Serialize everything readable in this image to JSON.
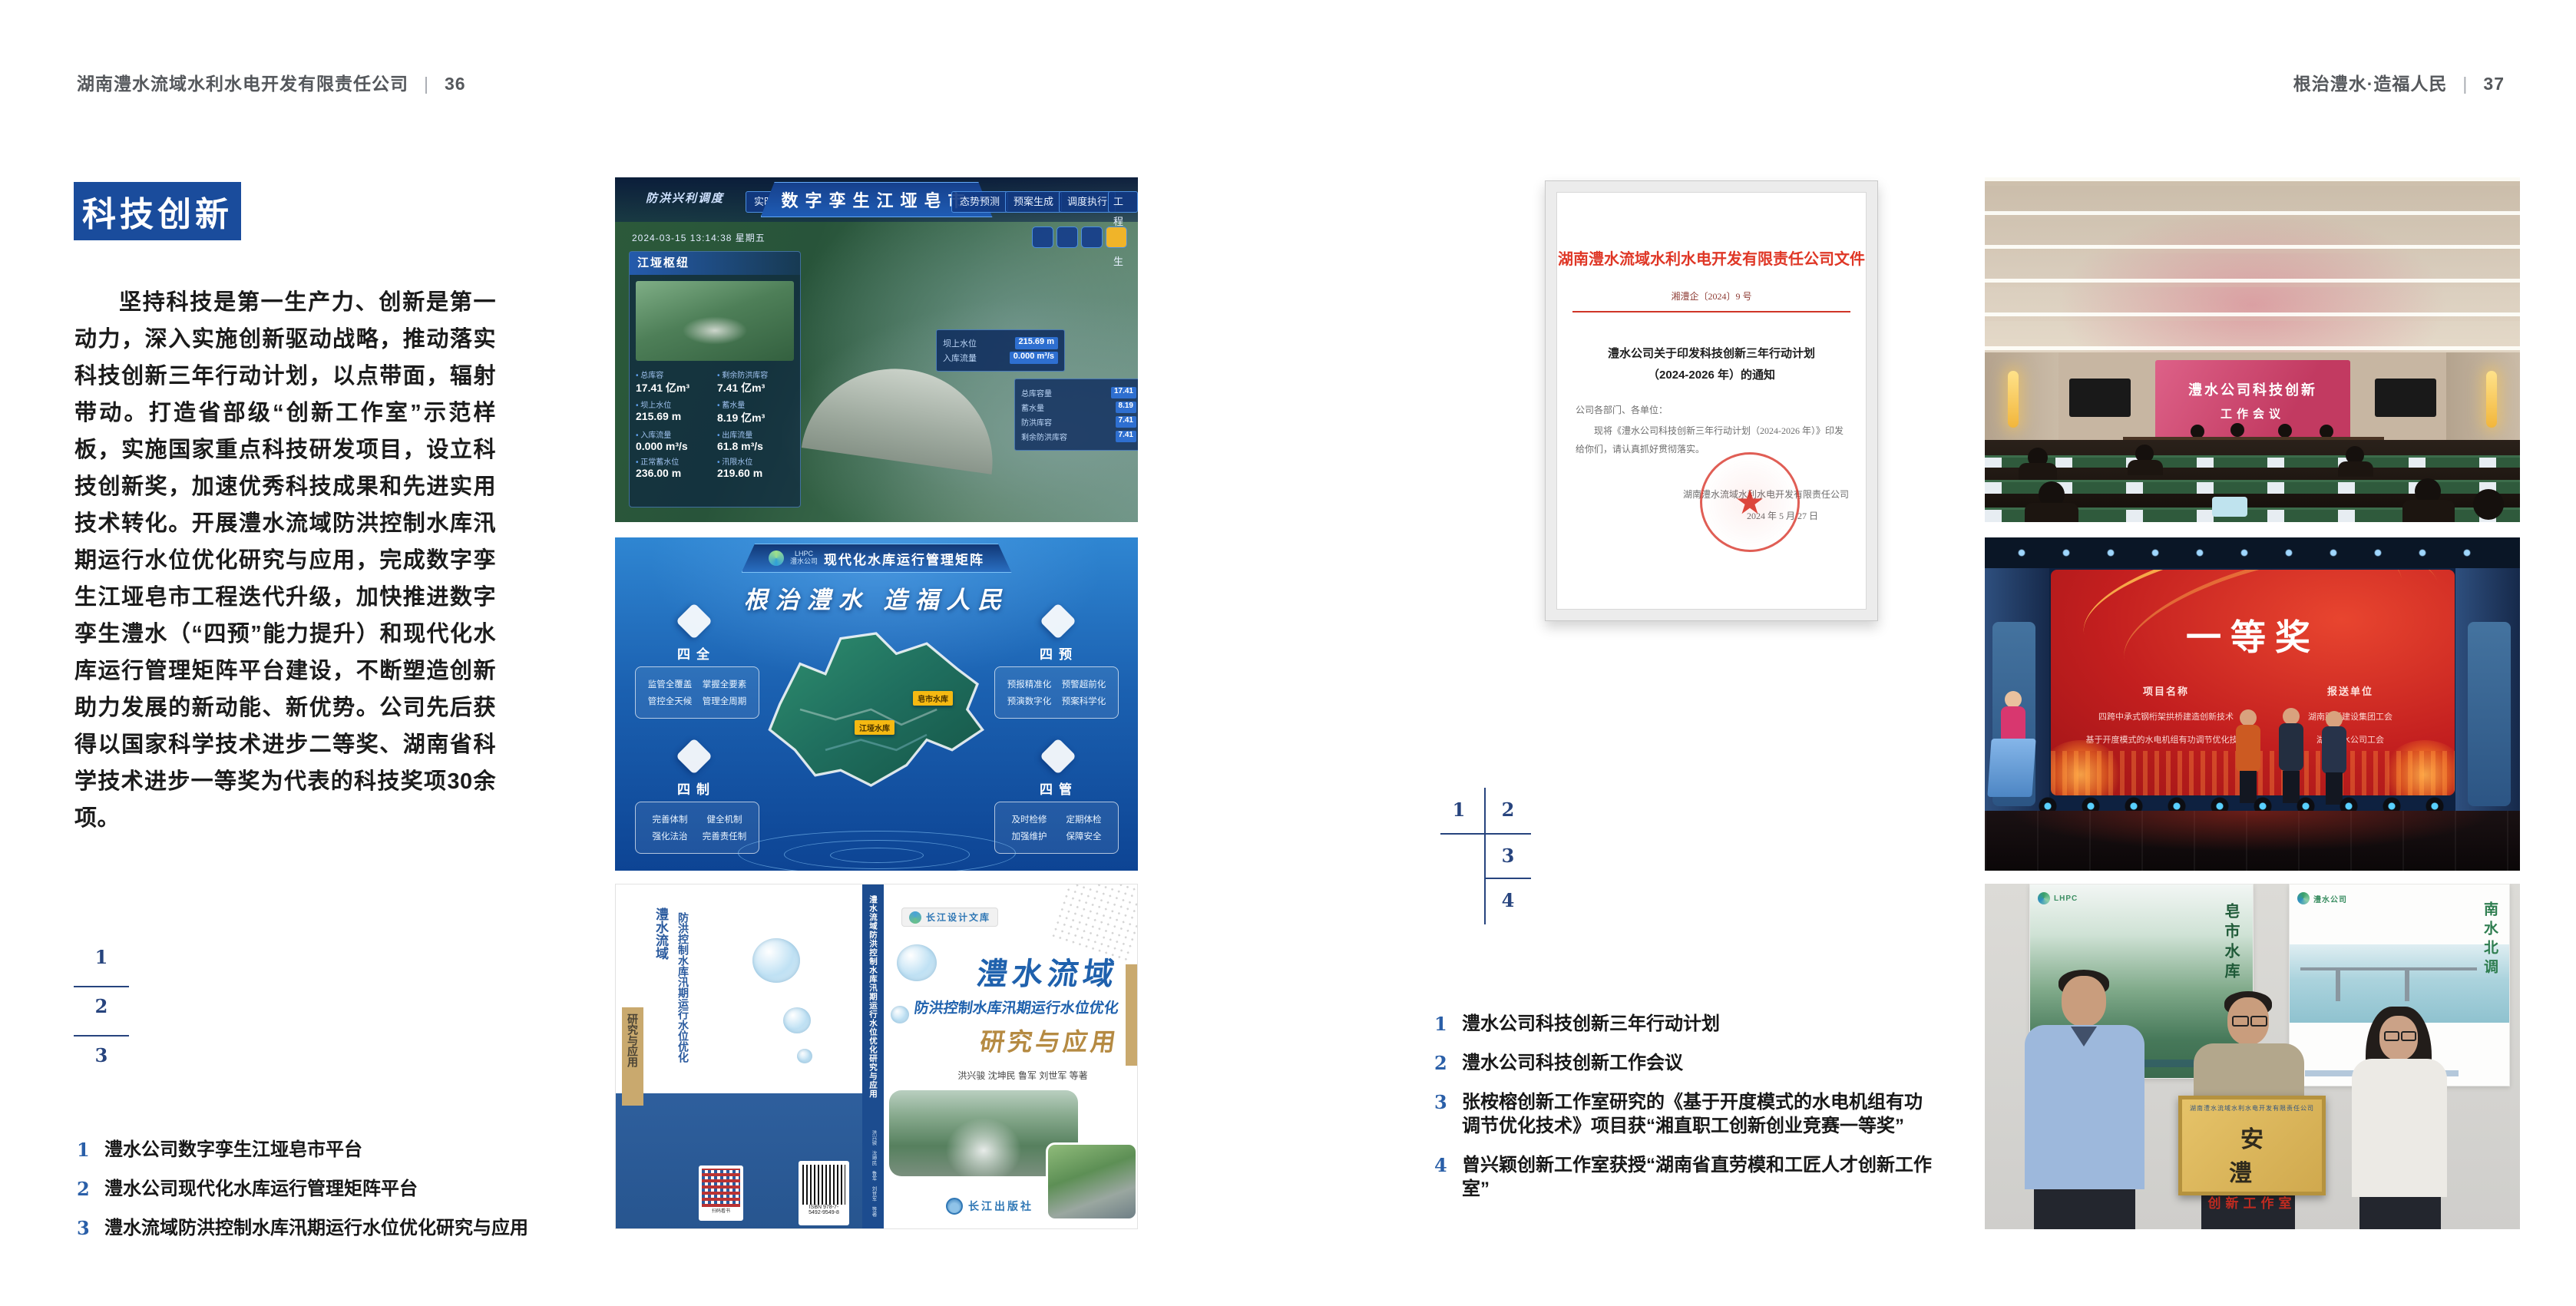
{
  "page_left": {
    "header": {
      "company": "湖南澧水流域水利水电开发有限责任公司",
      "separator": "|",
      "page_number": "36"
    },
    "section_title": "科技创新",
    "paragraph": "坚持科技是第一生产力、创新是第一动力，深入实施创新驱动战略，推动落实科技创新三年行动计划，以点带面，辐射带动。打造省部级“创新工作室”示范样板，实施国家重点科技研发项目，设立科技创新奖，加速优秀科技成果和先进实用技术转化。开展澧水流域防洪控制水库汛期运行水位优化研究与应用，完成数字孪生江垭皂市工程迭代升级，加快推进数字孪生澧水（“四预”能力提升）和现代化水库运行管理矩阵平台建设，不断塑造创新助力发展的新动能、新优势。公司先后获得以国家科学技术进步二等奖、湖南省科学技术进步一等奖为代表的科技奖项30余项。",
    "figure_index": {
      "n1": "1",
      "n2": "2",
      "n3": "3"
    },
    "captions": [
      {
        "no": "1",
        "text": "澧水公司数字孪生江垭皂市平台"
      },
      {
        "no": "2",
        "text": "澧水公司现代化水库运行管理矩阵平台"
      },
      {
        "no": "3",
        "text": "澧水流域防洪控制水库汛期运行水位优化研究与应用"
      }
    ],
    "platform": {
      "title": "数字孪生江垭皂市",
      "menu_label": "防洪兴利调度",
      "tabs_left": [
        "实时监测",
        "洪水预报",
        "防洪预警"
      ],
      "tabs_right": [
        "态势预测",
        "预案生成",
        "调度执行",
        "工程孪生"
      ],
      "timestamp": "2024-03-15 13:14:38 星期五",
      "panel_title": "江垭枢纽",
      "stats": [
        {
          "label": "总库容",
          "value": "17.41 亿m³"
        },
        {
          "label": "剩余防洪库容",
          "value": "7.41 亿m³"
        },
        {
          "label": "坝上水位",
          "value": "215.69 m"
        },
        {
          "label": "蓄水量",
          "value": "8.19 亿m³"
        },
        {
          "label": "入库流量",
          "value": "0.000 m³/s"
        },
        {
          "label": "出库流量",
          "value": "61.8 m³/s"
        },
        {
          "label": "正常蓄水位",
          "value": "236.00 m"
        },
        {
          "label": "汛限水位",
          "value": "219.60 m"
        }
      ],
      "chip_rows": [
        {
          "label": "坝上水位",
          "value": "215.69 m"
        },
        {
          "label": "入库流量",
          "value": "0.000 m³/s"
        }
      ],
      "side_rows": [
        {
          "label": "总库容量",
          "value": "17.41"
        },
        {
          "label": "蓄水量",
          "value": "8.19"
        },
        {
          "label": "防洪库容",
          "value": "7.41"
        },
        {
          "label": "剩余防洪库容",
          "value": "7.41"
        }
      ]
    },
    "matrix": {
      "logo_abbr": "LHPC",
      "logo_name": "澧水公司",
      "title": "现代化水库运行管理矩阵",
      "slogan": "根治澧水 造福人民",
      "groups": [
        {
          "name": "四全",
          "items": [
            "监管全覆盖",
            "掌握全要素",
            "管控全天候",
            "管理全周期"
          ]
        },
        {
          "name": "四预",
          "items": [
            "预报精准化",
            "预警超前化",
            "预演数字化",
            "预案科学化"
          ]
        },
        {
          "name": "四制",
          "items": [
            "完善体制",
            "健全机制",
            "强化法治",
            "完善责任制"
          ]
        },
        {
          "name": "四管",
          "items": [
            "及时检修",
            "定期体检",
            "加强维护",
            "保障安全"
          ]
        }
      ],
      "map_labels": [
        "皂市水库",
        "江垭水库"
      ]
    },
    "book": {
      "series": "长江设计文库",
      "title_main": "澧水流域",
      "title_sub": "防洪控制水库汛期运行水位优化",
      "title_tail": "研究与应用",
      "authors": "洪兴骏 沈坤民 鲁军 刘世军 等著",
      "publisher": "长江出版社",
      "spine_title": "澧水流域防洪控制水库汛期运行水位优化研究与应用"
    }
  },
  "page_right": {
    "header": {
      "motto": "根治澧水·造福人民",
      "separator": "|",
      "page_number": "37"
    },
    "document": {
      "masthead": "湖南澧水流域水利水电开发有限责任公司文件",
      "doc_no": "湘澧企〔2024〕9 号",
      "title_line1": "澧水公司关于印发科技创新三年行动计划",
      "title_line2": "（2024-2026 年）的通知",
      "salutation": "公司各部门、各单位：",
      "body": "现将《澧水公司科技创新三年行动计划（2024-2026 年）》印发给你们，请认真抓好贯彻落实。",
      "signer": "湖南澧水流域水利水电开发有限责任公司",
      "date": "2024 年 5 月 27 日",
      "seal_star": "★"
    },
    "figure_index": {
      "n1": "1",
      "n2": "2",
      "n3": "3",
      "n4": "4"
    },
    "captions": [
      {
        "no": "1",
        "text": "澧水公司科技创新三年行动计划"
      },
      {
        "no": "2",
        "text": "澧水公司科技创新工作会议"
      },
      {
        "no": "3",
        "text": "张桉榕创新工作室研究的《基于开度模式的水电机组有功调节优化技术》项目获“湘直职工创新创业竞赛一等奖”"
      },
      {
        "no": "4",
        "text": "曾兴颖创新工作室获授“湖南省直劳模和工匠人才创新工作室”"
      }
    ],
    "meeting": {
      "screen_line1": "澧水公司科技创新",
      "screen_line2": "工作会议"
    },
    "award": {
      "title": "一等奖",
      "col1": "项目名称",
      "col2": "报送单位",
      "rows": [
        {
          "project": "四跨中承式钢桁架拱桥建造创新技术",
          "org": "湖南路桥建设集团工会"
        },
        {
          "project": "基于开度模式的水电机组有功调节优化技术",
          "org": "湖南澧水公司工会"
        }
      ]
    },
    "plaque": {
      "header": "湖南澧水流域水利水电开发有限责任公司",
      "title": "安 澧",
      "subtitle": "创新工作室",
      "poster_left_text": "皂市水库",
      "poster_right_text": "南水北调",
      "logo_abbr": "LHPC",
      "logo_name": "澧水公司"
    }
  },
  "colors": {
    "accent_blue": "#1a4c9c",
    "index_navy": "#27447e",
    "caption_number_blue": "#2a5fa8",
    "doc_red": "#df3726",
    "header_gray": "#55585c",
    "text_dark": "#1b1b1b"
  }
}
